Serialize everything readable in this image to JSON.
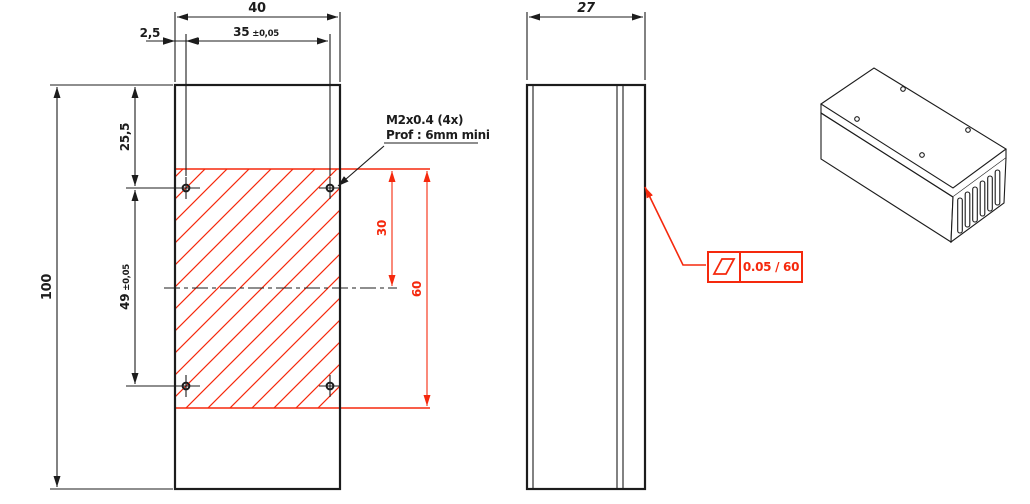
{
  "drawing": {
    "colors": {
      "background": "#ffffff",
      "line": "#1c1c1c",
      "accent_red": "#f5290d"
    },
    "front_view": {
      "width": "40",
      "edge_offset": "2,5",
      "holes_dx": "35",
      "holes_dx_tol": "±0,05",
      "top_to_hole": "25,5",
      "holes_dy": "49",
      "holes_dy_tol": "±0,05",
      "height": "100",
      "zone_to_center": "30",
      "zone_height": "60",
      "thread_callout": "M2x0.4 (4x)",
      "thread_depth": "Prof : 6mm mini"
    },
    "side_view": {
      "depth": "27"
    },
    "flatness_frame": {
      "symbol_icon": "flatness-parallelogram-icon",
      "value": "0.05 / 60"
    }
  }
}
